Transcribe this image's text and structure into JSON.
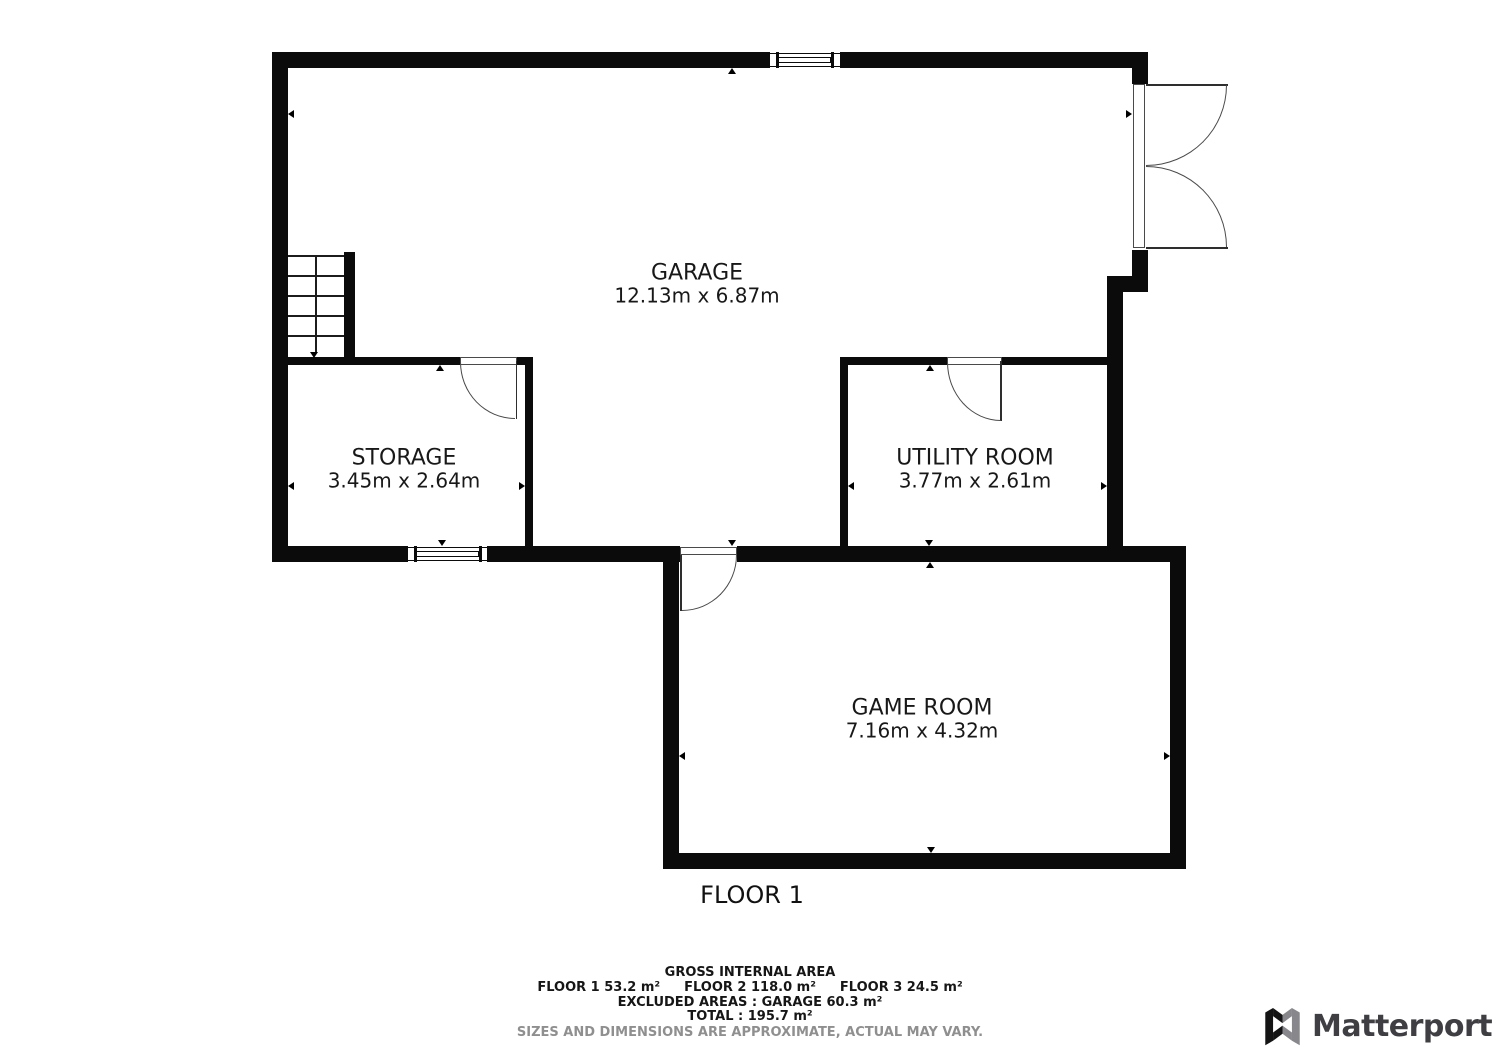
{
  "floor": {
    "label": "FLOOR 1"
  },
  "rooms": [
    {
      "id": "garage",
      "name": "GARAGE",
      "dimensions": "12.13m x 6.87m"
    },
    {
      "id": "storage",
      "name": "STORAGE",
      "dimensions": "3.45m x 2.64m"
    },
    {
      "id": "utility",
      "name": "UTILITY ROOM",
      "dimensions": "3.77m x 2.61m"
    },
    {
      "id": "game",
      "name": "GAME ROOM",
      "dimensions": "7.16m x 4.32m"
    }
  ],
  "area_summary": {
    "title": "GROSS INTERNAL AREA",
    "floor_areas": [
      "FLOOR 1 53.2 m²",
      "FLOOR 2 118.0 m²",
      "FLOOR 3 24.5 m²"
    ],
    "excluded_areas": "EXCLUDED AREAS :  GARAGE 60.3 m²",
    "total": "TOTAL :  195.7 m²",
    "disclaimer": "SIZES AND DIMENSIONS ARE APPROXIMATE, ACTUAL MAY VARY."
  },
  "branding": {
    "logo_text": "Matterport",
    "logo_icon": "matterport-m-icon"
  },
  "colors": {
    "wall": "#0b0b0b",
    "background": "#ffffff",
    "disclaimer_text": "#8f8f8f",
    "logo_text": "#3e3e43"
  }
}
